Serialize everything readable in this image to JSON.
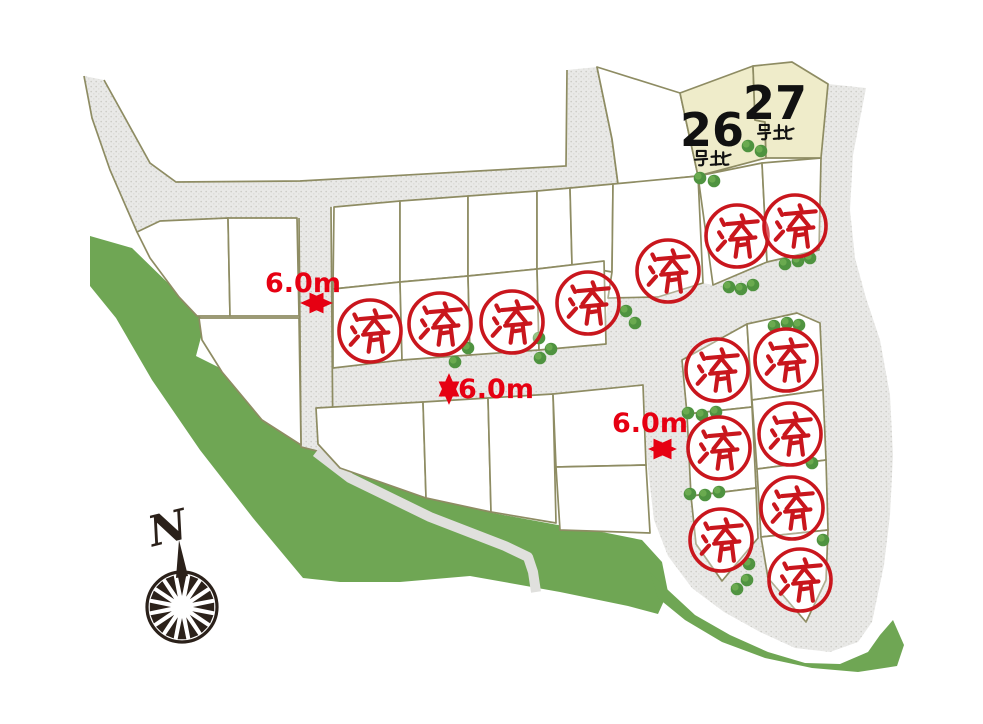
{
  "map": {
    "canvas": {
      "width": 983,
      "height": 724
    },
    "colors": {
      "background": "#ffffff",
      "road_fill": "#e9e9e7",
      "road_speckle1": "#cccbc6",
      "road_speckle2": "#d8d7d2",
      "parcel_border": "#8e8c63",
      "parcel_fill": "#ffffff",
      "available_fill": "#efecca",
      "green_area": "#6fa654",
      "bush_dark": "#4f9340",
      "bush_light": "#6fae52",
      "stamp_red": "#c9161d",
      "dimension_red": "#e60012",
      "compass_dark": "#2b211a",
      "number_black": "#111111"
    },
    "greens": [
      {
        "name": "hillside-band-west",
        "points": "90,236 132,248 170,285 205,322 196,356 220,368 262,416 300,442 344,466 428,497 493,513 558,525 602,532 642,540 662,562 668,592 658,614 628,606 560,592 470,576 400,582 340,582 303,578 253,518 200,450 152,380 116,318 90,286"
      },
      {
        "name": "hillside-band-southeast",
        "points": "650,572 668,590 695,615 730,635 768,652 805,663 840,664 868,652 880,635 893,620 904,645 897,666 858,672 812,668 765,658 722,642 685,620 658,598"
      }
    ],
    "roads": {
      "polygons": [
        {
          "name": "road-north",
          "points": "84,76 104,80 150,163 176,182 300,181 566,166 567,70 597,67 612,139 618,184 583,191 570,188 537,190 470,195 400,200 334,206 331,207 299,218 297,218 227,219 160,221 137,232 110,170 92,118"
        },
        {
          "name": "road-vertical-west",
          "points": "299,218 331,207 333,455 301,447"
        },
        {
          "name": "road-middle",
          "points": "301,363 333,368 402,360 470,355 539,350 604,344 608,298 658,297 703,283 713,285 820,252 832,292 840,330 820,323 797,313 747,324 682,360 643,368 646,385 553,394 423,402 316,408 301,409"
        },
        {
          "name": "road-east-loop",
          "points": "643,368 647,460 654,520 668,556 692,588 724,612 760,632 795,648 830,652 858,642 872,622 884,565 890,515 893,455 890,395 880,340 866,298 855,258 850,210 853,155 866,88 828,84 816,160 814,215 819,250 767,262 713,285 660,297"
        }
      ],
      "edge_lines": [
        "M104,80 L150,163 L176,182 L300,181 L566,166 L567,70",
        "M597,67 L612,139 L618,184 L583,191",
        "M84,76 L92,118 L110,170 L137,232",
        "M299,218 L301,447 L333,455 L331,207"
      ],
      "walkway": {
        "points": "316,452 350,478 430,517 505,546 528,557 533,572 536,592",
        "width": 10
      }
    },
    "lots": {
      "empty": [
        {
          "name": "parcel",
          "points": "137,232 160,221 228,218 230,316 197,316 179,297 150,258"
        },
        {
          "name": "parcel",
          "points": "228,218 297,218 299,316 230,316"
        },
        {
          "name": "parcel",
          "points": "199,318 299,318 301,445 262,420 222,372 202,340"
        },
        {
          "name": "parcel",
          "points": "334,207 400,201 400,282 333,289"
        },
        {
          "name": "parcel",
          "points": "400,201 468,196 468,276 400,282"
        },
        {
          "name": "parcel",
          "points": "468,196 537,191 537,269 468,276"
        },
        {
          "name": "parcel",
          "points": "537,191 570,188 572,265 537,269"
        },
        {
          "name": "parcel",
          "points": "570,188 613,184 612,272 572,265"
        },
        {
          "name": "parcel",
          "points": "597,67 680,93 698,176 618,184 612,139"
        },
        {
          "name": "parcel",
          "points": "316,408 423,402 426,498 340,468 318,444"
        },
        {
          "name": "parcel",
          "points": "423,402 488,398 491,512 426,498"
        },
        {
          "name": "parcel",
          "points": "488,398 553,394 556,523 491,512"
        },
        {
          "name": "parcel",
          "points": "553,394 643,385 646,465 556,467"
        },
        {
          "name": "parcel",
          "points": "556,467 646,465 650,533 560,530"
        }
      ],
      "sold": [
        {
          "name": "sold-parcel",
          "points": "333,289 400,282 402,360 333,368",
          "stamp": [
            370,
            331
          ]
        },
        {
          "name": "sold-parcel",
          "points": "400,282 468,276 470,355 402,360",
          "stamp": [
            440,
            324
          ]
        },
        {
          "name": "sold-parcel",
          "points": "468,276 537,269 539,350 470,355",
          "stamp": [
            512,
            322
          ]
        },
        {
          "name": "sold-parcel",
          "points": "537,269 604,261 606,344 539,350",
          "stamp": [
            588,
            303
          ]
        },
        {
          "name": "sold-parcel",
          "points": "613,184 698,176 703,283 658,297 608,298 612,272",
          "stamp": [
            668,
            271
          ]
        },
        {
          "name": "sold-parcel",
          "points": "698,176 762,163 767,262 713,285",
          "stamp": [
            737,
            236
          ]
        },
        {
          "name": "sold-parcel",
          "points": "762,163 821,158 819,250 767,262",
          "stamp": [
            795,
            226
          ]
        },
        {
          "name": "sold-parcel",
          "points": "682,360 747,324 752,407 687,414",
          "stamp": [
            717,
            370
          ]
        },
        {
          "name": "sold-parcel",
          "points": "687,414 752,407 756,488 691,496",
          "stamp": [
            719,
            448
          ]
        },
        {
          "name": "sold-parcel",
          "points": "691,496 756,488 758,538 722,581 696,544",
          "stamp": [
            721,
            540
          ]
        },
        {
          "name": "sold-parcel",
          "points": "747,324 797,313 820,323 823,390 752,400",
          "stamp": [
            786,
            360
          ]
        },
        {
          "name": "sold-parcel",
          "points": "752,400 823,390 826,460 757,469",
          "stamp": [
            790,
            434
          ]
        },
        {
          "name": "sold-parcel",
          "points": "757,469 826,460 828,530 761,537",
          "stamp": [
            792,
            508
          ]
        },
        {
          "name": "sold-parcel",
          "points": "761,537 828,530 826,580 806,622 768,578",
          "stamp": [
            800,
            580
          ]
        }
      ],
      "available": [
        {
          "name": "available-parcel-26",
          "points": "680,93 753,66 755,120 765,122 766,158 698,176"
        },
        {
          "name": "available-parcel-27",
          "points": "753,66 792,62 828,84 821,158 766,158 765,122 755,120"
        }
      ]
    },
    "available_lots": [
      {
        "number": "26",
        "suffix": "号地",
        "number_pos": [
          712,
          146
        ],
        "suffix_pos": [
          694,
          150
        ]
      },
      {
        "number": "27",
        "suffix": "号地",
        "number_pos": [
          775,
          119
        ],
        "suffix_pos": [
          757,
          124
        ]
      }
    ],
    "sold_stamp": {
      "char": "済",
      "meaning": "sold",
      "radius": 31
    },
    "dimensions": [
      {
        "label": "6.0m",
        "label_pos": [
          303,
          292
        ],
        "arrow": {
          "x1": 304,
          "y1": 303,
          "x2": 329,
          "y2": 303
        }
      },
      {
        "label": "6.0m",
        "label_pos": [
          489,
          393
        ],
        "arrow": {
          "x1": 449,
          "y1": 377,
          "x2": 449,
          "y2": 401
        }
      },
      {
        "label": "6.0m",
        "label_pos": [
          650,
          432
        ],
        "arrow": {
          "x1": 652,
          "y1": 449,
          "x2": 673,
          "y2": 449
        }
      }
    ],
    "compass": {
      "label": "N",
      "cx": 182,
      "cy": 607,
      "r": 35,
      "label_pos": [
        150,
        545
      ],
      "label_rotation": -14
    },
    "bushes": [
      [
        700,
        178
      ],
      [
        714,
        181
      ],
      [
        748,
        146
      ],
      [
        761,
        151
      ],
      [
        455,
        362
      ],
      [
        468,
        348
      ],
      [
        539,
        338
      ],
      [
        551,
        349
      ],
      [
        540,
        358
      ],
      [
        626,
        311
      ],
      [
        635,
        323
      ],
      [
        785,
        264
      ],
      [
        798,
        261
      ],
      [
        810,
        258
      ],
      [
        729,
        287
      ],
      [
        741,
        289
      ],
      [
        753,
        285
      ],
      [
        774,
        326
      ],
      [
        787,
        323
      ],
      [
        799,
        325
      ],
      [
        688,
        413
      ],
      [
        702,
        415
      ],
      [
        716,
        412
      ],
      [
        690,
        494
      ],
      [
        705,
        495
      ],
      [
        719,
        492
      ],
      [
        812,
        463
      ],
      [
        823,
        540
      ],
      [
        737,
        589
      ],
      [
        747,
        580
      ],
      [
        749,
        564
      ]
    ]
  }
}
